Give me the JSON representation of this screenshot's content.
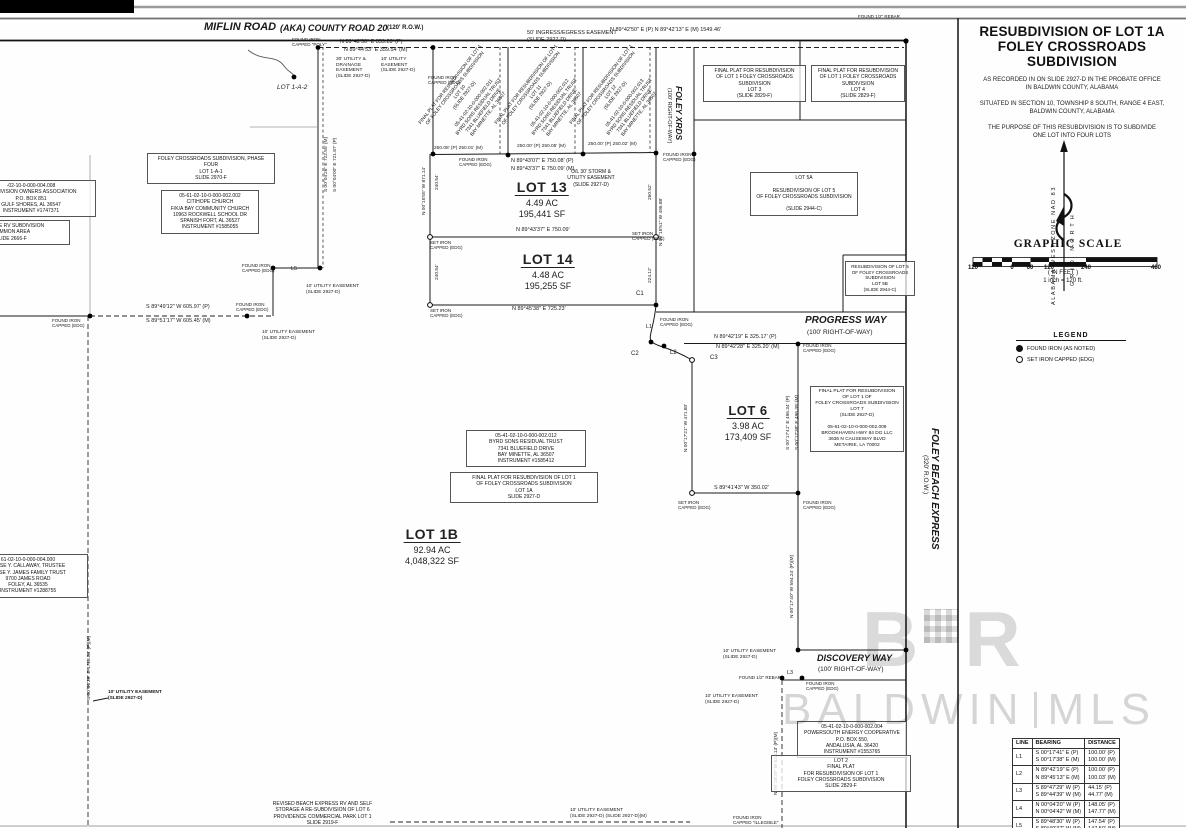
{
  "title_block": {
    "line1": "RESUBDIVISION OF LOT 1A",
    "line2": "FOLEY CROSSROADS SUBDIVISION",
    "recorded": "AS RECORDED IN ON SLIDE 2927-D IN THE PROBATE OFFICE\nIN BALDWIN COUNTY, ALABAMA",
    "situated": "SITUATED IN SECTION 10, TOWNSHIP 8 SOUTH, RANGE 4 EAST,\nBALDWIN COUNTY, ALABAMA",
    "purpose": "THE PURPOSE OF THIS RESUBDIVISION IS TO SUBDIVIDE\nONE LOT INTO FOUR LOTS"
  },
  "north_arrow": {
    "left_label": "ALABAMA WEST ZONE NAD 83",
    "right_label": "GRID NORTH"
  },
  "graphic_scale": {
    "title": "GRAPHIC SCALE",
    "ticks": [
      {
        "label": "120",
        "x": 973
      },
      {
        "label": "0",
        "x": 1012
      },
      {
        "label": "60",
        "x": 1030
      },
      {
        "label": "120",
        "x": 1049
      },
      {
        "label": "240",
        "x": 1086
      },
      {
        "label": "480",
        "x": 1156
      }
    ],
    "units": "( IN FEET )",
    "ratio": "1 inch = 120 ft."
  },
  "legend": {
    "title": "LEGEND",
    "items": [
      {
        "symbol": "filled-circle",
        "label": "FOUND IRON (AS NOTED)"
      },
      {
        "symbol": "open-circle",
        "label": "SET IRON CAPPED (EDG)"
      }
    ]
  },
  "line_table": {
    "headers": [
      "LINE",
      "BEARING",
      "DISTANCE"
    ],
    "rows": [
      {
        "line": "L1",
        "bearing": "S 00°17'41\" E (P)\nS 00°17'38\" E (M)",
        "distance": "100.00' (P)\n100.00' (M)"
      },
      {
        "line": "L2",
        "bearing": "N 89°42'19\" E (P)\nN 89°45'13\" E (M)",
        "distance": "100.00' (P)\n100.03' (M)"
      },
      {
        "line": "L3",
        "bearing": "S 89°47'29\" W (P)\nS 89°44'39\" W (M)",
        "distance": "44.15' (P)\n44.77' (M)"
      },
      {
        "line": "L4",
        "bearing": "N 00°04'20\" W (P)\nN 00°04'42\" W (M)",
        "distance": "148.05' (P)\n147.77' (M)"
      },
      {
        "line": "L5",
        "bearing": "S 89°48'30\" W (P)\nS 89°49'37\" W (M)",
        "distance": "147.54' (P)\n147.50' (M)"
      }
    ]
  },
  "watermark": {
    "logo_left": "B",
    "logo_right": "R",
    "name": "BALDWIN",
    "suffix": "MLS"
  },
  "map": {
    "lot_labels": [
      {
        "name": "LOT 13",
        "ac": "4.49 AC",
        "sf": "195,441 SF",
        "cx": 542,
        "y": 179,
        "nfs": 14,
        "afs": 9
      },
      {
        "name": "LOT 14",
        "ac": "4.48 AC",
        "sf": "195,255 SF",
        "cx": 548,
        "y": 251,
        "nfs": 14,
        "afs": 9
      },
      {
        "name": "LOT 6",
        "ac": "3.98 AC",
        "sf": "173,409 SF",
        "cx": 748,
        "y": 402,
        "nfs": 13,
        "afs": 9
      },
      {
        "name": "LOT 1B",
        "ac": "92.94 AC",
        "sf": "4,048,322 SF",
        "cx": 432,
        "y": 526,
        "nfs": 14,
        "afs": 9
      }
    ],
    "roads": [
      {
        "t": "MIFLIN ROAD",
        "x": 204,
        "y": 21,
        "fs": 11,
        "b": 1,
        "i": 1
      },
      {
        "t": "(AKA) COUNTY ROAD 20",
        "x": 280,
        "y": 22.5,
        "fs": 9,
        "b": 1,
        "i": 1
      },
      {
        "t": "(120' R.O.W.)",
        "x": 387,
        "y": 24.5,
        "fs": 6,
        "b": 1
      },
      {
        "t": "FOLEY XRDS",
        "x": 684,
        "y": 86,
        "fs": 8.5,
        "b": 1,
        "i": 1,
        "rot": 90
      },
      {
        "t": "(100' RIGHT-OF-WAY)",
        "x": 672,
        "y": 88,
        "fs": 5.5,
        "rot": 90
      },
      {
        "t": "PROGRESS WAY",
        "x": 805,
        "y": 315,
        "fs": 10,
        "b": 1,
        "i": 1
      },
      {
        "t": "(100' RIGHT-OF-WAY)",
        "x": 807,
        "y": 329,
        "fs": 6.5
      },
      {
        "t": "FOLEY BEACH EXPRESS",
        "x": 940,
        "y": 428,
        "fs": 10,
        "b": 1,
        "i": 1,
        "rot": 90
      },
      {
        "t": "(320' R.O.W.)",
        "x": 929,
        "y": 455,
        "fs": 6.5,
        "rot": 90
      },
      {
        "t": "DISCOVERY WAY",
        "x": 817,
        "y": 653,
        "fs": 9,
        "b": 1,
        "i": 1
      },
      {
        "t": "(100' RIGHT-OF-WAY)",
        "x": 818,
        "y": 666,
        "fs": 6.5
      }
    ],
    "boxes": [
      {
        "id": "owners-association-box",
        "x": -34,
        "y": 180,
        "w": 122,
        "fs": 5,
        "border": 1,
        "lines": [
          "-02-10-0-000-004.008",
          "SUBDIVISION OWNERS ASSOCIATION",
          "P.O. BOX 851",
          "GULF SHORES, AL 36547",
          "INSTRUMENT #1747371"
        ]
      },
      {
        "id": "lakeside-rv-box",
        "x": -48,
        "y": 220,
        "w": 110,
        "fs": 5,
        "border": 1,
        "lines": [
          "LAKESIDE RV SUBDIVISION",
          "COMMON AREA",
          "SLIDE 2666-F"
        ]
      },
      {
        "id": "phase-four-box",
        "x": 147,
        "y": 153,
        "w": 120,
        "fs": 5,
        "border": 1,
        "lines": [
          "FOLEY CROSSROADS SUBDIVISION, PHASE FOUR",
          "LOT 1-A-1",
          "SLIDE 2970-F"
        ]
      },
      {
        "id": "citihope-church-box",
        "x": 161,
        "y": 190,
        "w": 90,
        "fs": 5,
        "border": 1,
        "lines": [
          "05-61-02-10-0-000-002.002",
          "CITIHOPE CHURCH",
          "F/K/A BAY COMMUNITY CHURCH",
          "10963 ROCKWELL SCHOOL DR",
          "SPANISH FORT, AL 36527",
          "INSTRUMENT #1585055"
        ]
      },
      {
        "id": "lot3-plat-box",
        "x": 703,
        "y": 65,
        "w": 95,
        "fs": 5,
        "border": 1,
        "lines": [
          "FINAL PLAT FOR RESUBDIVISION",
          "OF LOT 1 FOLEY CROSSROADS",
          "SUBDIVISION",
          "LOT 3",
          "(SLIDE 2829-F)"
        ]
      },
      {
        "id": "lot4-plat-box",
        "x": 811,
        "y": 65,
        "w": 86,
        "fs": 5,
        "border": 1,
        "lines": [
          "FINAL PLAT FOR RESUBDIVISION",
          "OF LOT 1 FOLEY CROSSROADS",
          "SUBDIVISION",
          "LOT 4",
          "(SLIDE 2829-F)"
        ]
      },
      {
        "id": "lot5a-box",
        "x": 750,
        "y": 172,
        "w": 100,
        "fs": 5,
        "border": 1,
        "lines": [
          "LOT 5A",
          "",
          "RESUBDIVISION OF LOT 5",
          "OF FOLEY CROSSROADS SUBDIVISION",
          "",
          "(SLIDE 2944-C)"
        ]
      },
      {
        "id": "lot5b-box",
        "x": 845,
        "y": 261,
        "w": 62,
        "fs": 4.6,
        "border": 1,
        "lines": [
          "RESUBDIVISION OF LOT 5",
          "OF FOLEY CROSSROADS",
          "SUBDIVISION",
          "LOT 5B",
          "(SLIDE 2944-C)"
        ]
      },
      {
        "id": "lot7-plat-box",
        "x": 810,
        "y": 386,
        "w": 86,
        "fs": 4.8,
        "border": 1,
        "lines": [
          "FINAL PLAT FOR RESUBDIVISION",
          "OF LOT 1 OF",
          "FOLEY CROSSROADS SUBDIVISION",
          "LOT 7",
          "(SLIDE 2927-D)",
          "",
          "05-61-02-10-0-000-002.009",
          "BROOKHAVEN HWY 84 DG LLC",
          "3636 N CAUSEWAY BLVD",
          "METAIRIE, LA 70002"
        ]
      },
      {
        "id": "byrd-sons-box",
        "x": 466,
        "y": 430,
        "w": 112,
        "fs": 5,
        "border": 1,
        "lines": [
          "05-41-02-10-0-000-002.012",
          "BYRD SONS RESIDUAL TRUST",
          "7341 BLUEFIELD DRIVE",
          "BAY MINETTE, AL 36507",
          "INSTRUMENT #1585412"
        ]
      },
      {
        "id": "lot1a-plat-box",
        "x": 450,
        "y": 472,
        "w": 140,
        "fs": 5,
        "border": 1,
        "lines": [
          "FINAL PLAT FOR RESUBDIVISION OF LOT 1",
          "OF FOLEY CROSSROADS SUBDIVISION",
          "LOT 1A",
          "SLIDE 2927-D"
        ]
      },
      {
        "id": "james-trust-box",
        "x": -32,
        "y": 554,
        "w": 112,
        "fs": 5,
        "border": 1,
        "lines": [
          "61-02-10-0-000-004.000",
          "JESSE Y. CALLAWAY, TRUSTEE",
          "JESSE Y. JAMES FAMILY TRUST",
          "9700 JAMES ROAD",
          "FOLEY, AL 36535",
          "INSTRUMENT #1288755"
        ]
      },
      {
        "id": "powersouth-box",
        "x": 797,
        "y": 721,
        "w": 102,
        "fs": 5,
        "border": 1,
        "lines": [
          "05-41-02-10-0-000-002.004",
          "POWERSOUTH ENERGY COOPERATIVE",
          "P.O. BOX 550,",
          "ANDALUSIA, AL 36420",
          "INSTRUMENT #1553765"
        ]
      },
      {
        "id": "lot2-plat-box",
        "x": 771,
        "y": 755,
        "w": 132,
        "fs": 5,
        "border": 1,
        "lines": [
          "LOT 2",
          "FINAL PLAT",
          "FOR RESUBDIVISION OF LOT 1",
          "FOLEY CROSSROADS SUBDIVISION",
          "SLIDE 2829-F"
        ]
      },
      {
        "id": "revised-beach-box",
        "x": 250,
        "y": 801,
        "w": 145,
        "fs": 5,
        "border": 0,
        "lines": [
          "REVISED BEACH EXPRESS RV AND SELF",
          "STORAGE A RE-SUBDIVISION OF LOT 6",
          "PROVIDENCE COMMERCIAL PARK LOT 1",
          "SLIDE 2919-F"
        ]
      },
      {
        "id": "storm-easement-note",
        "x": 558,
        "y": 169,
        "w": 66,
        "fs": 5,
        "border": 0,
        "lines": [
          "O/L 30' STORM &",
          "UTILITY EASEMENT",
          "(SLIDE 2927-D)"
        ]
      },
      {
        "id": "lot10-diagonal-note",
        "x": 470,
        "y": 100,
        "w": 118,
        "fs": 4.8,
        "border": 0,
        "rot": -52,
        "center": 1,
        "lines": [
          "FINAL PLAT FOR RESUBDIVISION OF LOT 1",
          "OF FOLEY CROSSROADS SUBDIVISION",
          "LOT 10",
          "(SLIDE 2927-D)",
          "",
          "05-41-02-10-0-000-002.011",
          "BYRD SONS RESIDUAL TRUST",
          "7341 BLUEFIELD DRIVE",
          "BAY MINETTE, AL 36507"
        ]
      },
      {
        "id": "lot11-diagonal-note",
        "x": 546,
        "y": 100,
        "w": 118,
        "fs": 4.8,
        "border": 0,
        "rot": -52,
        "center": 1,
        "lines": [
          "FINAL PLAT FOR RESUBDIVISION OF LOT 1",
          "OF FOLEY CROSSROADS SUBDIVISION",
          "LOT 11",
          "(SLIDE 2927-D)",
          "",
          "05-41-02-10-0-000-002.012",
          "BYRD SONS RESIDUAL TRUST",
          "7341 BLUEFIELD DRIVE",
          "BAY MINETTE, AL 36507"
        ]
      },
      {
        "id": "lot12-diagonal-note",
        "x": 621,
        "y": 100,
        "w": 118,
        "fs": 4.8,
        "border": 0,
        "rot": -52,
        "center": 1,
        "lines": [
          "FINAL PLAT FOR RESUBDIVISION OF LOT 1",
          "OF FOLEY CROSSROADS SUBDIVISION",
          "LOT 12",
          "(SLIDE 2927-D)",
          "",
          "05-41-02-10-0-000-002.013",
          "BYRD SONS RESIDUAL TRUST",
          "7341 BLUEFIELD DRIVE",
          "BAY MINETTE, AL 36507"
        ]
      }
    ],
    "labels": [
      {
        "t": "FOUND IRON\nCAPPED \"POLY\"",
        "x": 292,
        "y": 37,
        "fs": 4.5
      },
      {
        "t": "N 89°42'50\" E  359.20' (P)",
        "x": 340,
        "y": 39,
        "fs": 5.5
      },
      {
        "t": "N 89°44'53\" E  359.54' (M)",
        "x": 344,
        "y": 47,
        "fs": 5.5
      },
      {
        "t": "50' INGRESS/EGRESS EASEMENT",
        "x": 527,
        "y": 30,
        "fs": 5.5
      },
      {
        "t": "(SLIDE 2927-D)",
        "x": 527,
        "y": 37,
        "fs": 5.5
      },
      {
        "t": "N 89°42'50\" E (P)   N 89°42'13\" E (M)   1549.46'",
        "x": 610,
        "y": 27,
        "fs": 5.5
      },
      {
        "t": "FOUND 1/2\" REBAR",
        "x": 858,
        "y": 14,
        "fs": 4.5
      },
      {
        "t": "FOUND IRON\nCAPPED (EDG)",
        "x": 428,
        "y": 75,
        "fs": 4.5
      },
      {
        "t": "LOT 1-A-2",
        "x": 277,
        "y": 84,
        "fs": 6.5,
        "i": 1
      },
      {
        "t": "30' UTILITY &\nDRAINAGE\nEASEMENT\n(SLIDE 2927-D)",
        "x": 336,
        "y": 57,
        "fs": 4.8
      },
      {
        "t": "10' UTILITY\nEASEMENT\n(SLIDE 2927-D)",
        "x": 381,
        "y": 57,
        "fs": 4.8
      },
      {
        "t": "250.08' (P)  250.01' (M)",
        "x": 434,
        "y": 146,
        "fs": 4.8
      },
      {
        "t": "250.00' (P)  250.05' (M)",
        "x": 517,
        "y": 144,
        "fs": 4.8
      },
      {
        "t": "250.00' (P)  250.02' (M)",
        "x": 588,
        "y": 142,
        "fs": 4.8
      },
      {
        "t": "FOUND IRON\nCAPPED (EDG)",
        "x": 459,
        "y": 157,
        "fs": 4.5
      },
      {
        "t": "N 89°43'07\" E  750.08' (P)",
        "x": 511,
        "y": 158,
        "fs": 5.5
      },
      {
        "t": "N 89°43'37\" E  750.09' (M)",
        "x": 511,
        "y": 166,
        "fs": 5.5
      },
      {
        "t": "FOUND IRON\nCAPPED (EDG)",
        "x": 663,
        "y": 152,
        "fs": 4.5
      },
      {
        "t": "N 89°43'37\" E  750.09'",
        "x": 516,
        "y": 227,
        "fs": 5.5
      },
      {
        "t": "SET IRON\nCAPPED (EDG)",
        "x": 430,
        "y": 240,
        "fs": 4.5
      },
      {
        "t": "SET IRON\nCAPPED (EDG)",
        "x": 632,
        "y": 231,
        "fs": 4.5
      },
      {
        "t": "N 89°45'38\" E  725.23'",
        "x": 512,
        "y": 306,
        "fs": 5.5
      },
      {
        "t": "SET IRON\nCAPPED (EDG)",
        "x": 430,
        "y": 308,
        "fs": 4.5
      },
      {
        "t": "S 89°49'12\" W  605.97' (P)",
        "x": 146,
        "y": 304,
        "fs": 5.5
      },
      {
        "t": "S 89°51'17\" W  605.45' (M)",
        "x": 146,
        "y": 318,
        "fs": 5.5
      },
      {
        "t": "FOUND IRON\nCAPPED (EDG)",
        "x": 52,
        "y": 318,
        "fs": 4.5
      },
      {
        "t": "FOUND IRON\nCAPPED (EDG)",
        "x": 236,
        "y": 302,
        "fs": 4.5
      },
      {
        "t": "FOUND IRON\nCAPPED (EDG)",
        "x": 242,
        "y": 263,
        "fs": 4.5
      },
      {
        "t": "L5",
        "x": 291,
        "y": 266,
        "fs": 5.5
      },
      {
        "t": "10' UTILITY EASEMENT\n(SLIDE 2927-D)",
        "x": 306,
        "y": 284,
        "fs": 4.8
      },
      {
        "t": "10' UTILITY EASEMENT\n(SLIDE 2927-D)",
        "x": 262,
        "y": 330,
        "fs": 4.8
      },
      {
        "t": "N 89°42'19\" E  325.17' (P)",
        "x": 714,
        "y": 334,
        "fs": 5.5
      },
      {
        "t": "N 89°42'28\" E  325.20' (M)",
        "x": 716,
        "y": 344,
        "fs": 5.5
      },
      {
        "t": "FOUND IRON\nCAPPED (EDG)",
        "x": 803,
        "y": 343,
        "fs": 4.5
      },
      {
        "t": "S 89°41'43\" W  350.02'",
        "x": 714,
        "y": 485,
        "fs": 5.5
      },
      {
        "t": "SET IRON\nCAPPED (EDG)",
        "x": 678,
        "y": 500,
        "fs": 4.5
      },
      {
        "t": "FOUND IRON\nCAPPED (EDG)",
        "x": 803,
        "y": 500,
        "fs": 4.5
      },
      {
        "t": "C1",
        "x": 636,
        "y": 291,
        "fs": 6
      },
      {
        "t": "L1",
        "x": 646,
        "y": 324,
        "fs": 5.5
      },
      {
        "t": "C2",
        "x": 631,
        "y": 351,
        "fs": 6
      },
      {
        "t": "L2",
        "x": 670,
        "y": 350,
        "fs": 6
      },
      {
        "t": "C3",
        "x": 710,
        "y": 355,
        "fs": 6
      },
      {
        "t": "FOUND IRON\nCAPPED (EDG)",
        "x": 660,
        "y": 317,
        "fs": 4.5
      },
      {
        "t": "10' UTILITY EASEMENT\n(SLIDE 2927-D)",
        "x": 723,
        "y": 649,
        "fs": 4.8
      },
      {
        "t": "FOUND 1/2\" REBAR",
        "x": 739,
        "y": 675,
        "fs": 4.5
      },
      {
        "t": "L3",
        "x": 787,
        "y": 670,
        "fs": 5.5
      },
      {
        "t": "FOUND IRON\nCAPPED (EDG)",
        "x": 806,
        "y": 681,
        "fs": 4.5
      },
      {
        "t": "10' UTILITY EASEMENT\n(SLIDE 2927-D)",
        "x": 705,
        "y": 694,
        "fs": 4.8
      },
      {
        "t": "10' UTILITY EASEMENT\n(SLIDE 2927-D)",
        "x": 108,
        "y": 690,
        "fs": 4.8,
        "b": 1
      },
      {
        "t": "10' UTILITY EASEMENT\n(SLIDE 2927-D)   (SLIDE 2927-D)(M)",
        "x": 570,
        "y": 808,
        "fs": 4.8
      },
      {
        "t": "FOUND IRON\nCAPPED \"ILLEGIBLE\"",
        "x": 733,
        "y": 815,
        "fs": 4.5
      },
      {
        "t": "S 00°04'26\" E  722.55' (M)",
        "x": 324,
        "y": 192,
        "fs": 4.8,
        "rot": -90
      },
      {
        "t": "S 00°04'00\" E  721.87' (P)",
        "x": 333,
        "y": 192,
        "fs": 4.8,
        "rot": -90
      },
      {
        "t": "N 00°15'55\" W  871.14'",
        "x": 422,
        "y": 215,
        "fs": 4.8,
        "rot": -90
      },
      {
        "t": "240.54'",
        "x": 435,
        "y": 190,
        "fs": 4.8,
        "rot": -90
      },
      {
        "t": "240.54'",
        "x": 435,
        "y": 280,
        "fs": 4.8,
        "rot": -90
      },
      {
        "t": "260.52'",
        "x": 648,
        "y": 200,
        "fs": 4.8,
        "rot": -90
      },
      {
        "t": "N 00°15'51\" W  496.88'",
        "x": 659,
        "y": 246,
        "fs": 4.8,
        "rot": -90
      },
      {
        "t": "224.12'",
        "x": 648,
        "y": 283,
        "fs": 4.8,
        "rot": -90
      },
      {
        "t": "N 00°17'21\" W  471.80'",
        "x": 684,
        "y": 452,
        "fs": 4.8,
        "rot": -90
      },
      {
        "t": "S 00°17'41\" E  496.34' (P)",
        "x": 786,
        "y": 450,
        "fs": 4.8,
        "rot": -90
      },
      {
        "t": "S 00°17'39\" E  496.39' (M)",
        "x": 795,
        "y": 450,
        "fs": 4.8,
        "rot": -90
      },
      {
        "t": "N 00°17'40\" W  594.24' (P)(M)",
        "x": 790,
        "y": 618,
        "fs": 4.8,
        "rot": -90
      },
      {
        "t": "S 00°00'29\" E  1713.34' (P)(M)",
        "x": 87,
        "y": 700,
        "fs": 4.8,
        "rot": -90
      },
      {
        "t": "N 00°18'29\" W  622.13' (P)(M)",
        "x": 774,
        "y": 795,
        "fs": 4.8,
        "rot": -90
      }
    ]
  }
}
